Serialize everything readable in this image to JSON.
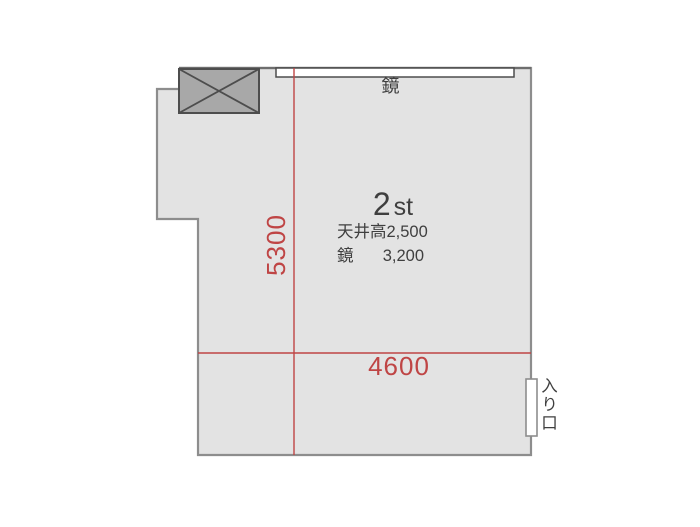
{
  "floorplan": {
    "room_title": {
      "number": "2",
      "suffix": "st"
    },
    "mirror_wall_label": "鏡",
    "specs": [
      {
        "label": "天井高",
        "value": "2,500"
      },
      {
        "label": "鏡",
        "value": "3,200"
      }
    ],
    "dimensions": {
      "width_mm": "4600",
      "depth_mm": "5300"
    },
    "entrance_label": "入り口",
    "colors": {
      "room_fill": "#e3e3e3",
      "wall_stroke": "#8d8d8d",
      "column_fill": "#a8a8a8",
      "column_stroke": "#4d4d4d",
      "mirror_fill": "#ffffff",
      "dimension_red": "#bf4545",
      "text_dark": "#3f3f3f"
    }
  }
}
